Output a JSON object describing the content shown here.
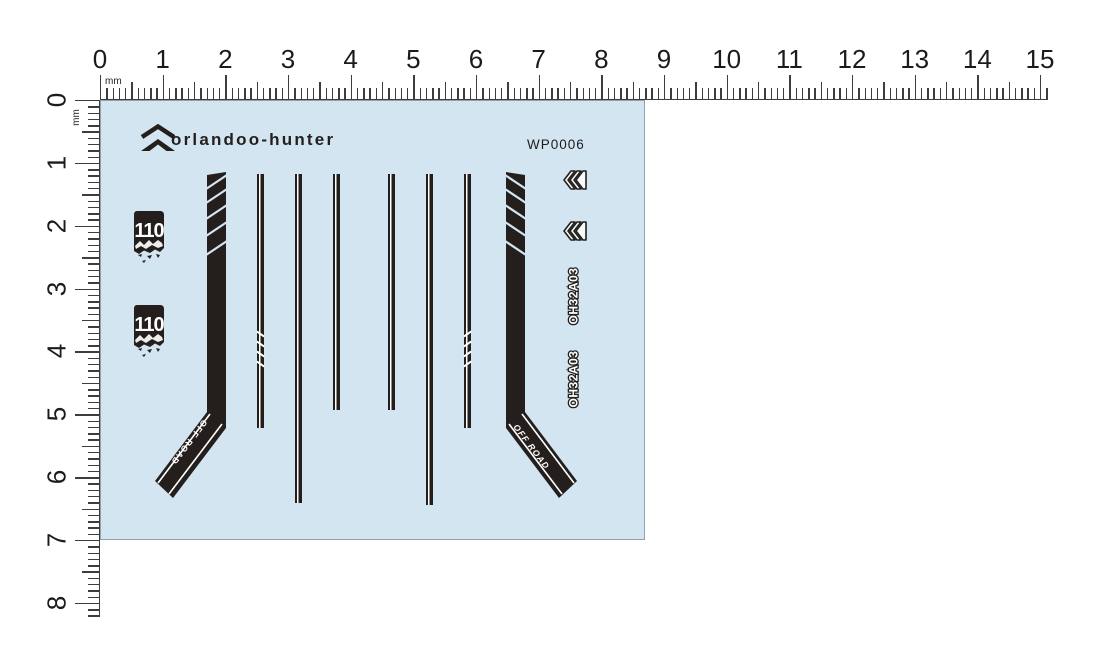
{
  "sheet": {
    "brand": "orlandoo-hunter",
    "product_code": "WP0006",
    "badge_text": "110",
    "off_road_label": "OFF ROAD",
    "model_code": "OH32A03",
    "colors": {
      "sheet_bg": "#d3e5f1",
      "decal_black": "#241f1c",
      "decal_white": "#ffffff"
    },
    "icons": [
      "brand-logo-chevron-icon",
      "chevron-mark-icon",
      "chevron-mark-icon"
    ]
  },
  "rulers": {
    "unit_label": "mm",
    "horizontal": {
      "numbers": [
        "0",
        "1",
        "2",
        "3",
        "4",
        "5",
        "6",
        "7",
        "8",
        "9",
        "10",
        "11",
        "12",
        "13",
        "14",
        "15"
      ]
    },
    "vertical": {
      "numbers": [
        "0",
        "1",
        "2",
        "3",
        "4",
        "5",
        "6",
        "7",
        "8"
      ]
    }
  }
}
